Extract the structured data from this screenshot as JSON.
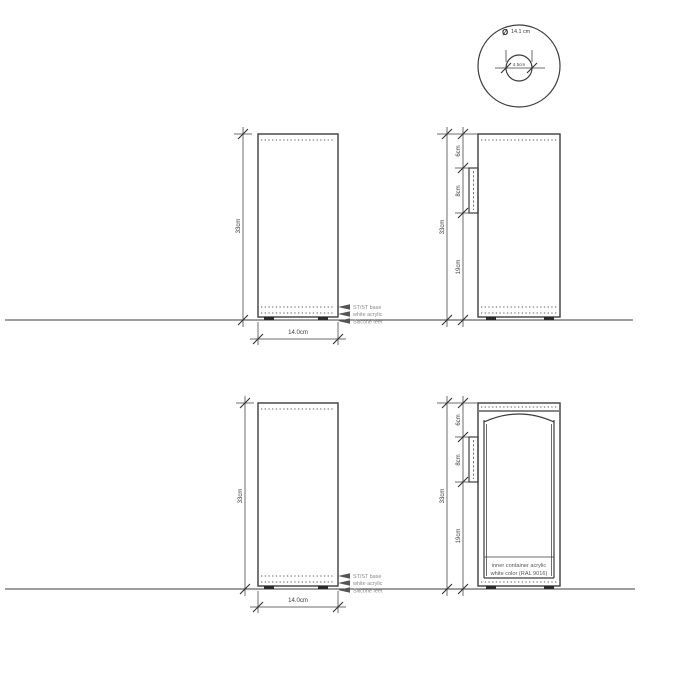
{
  "dimensions": {
    "height": "33cm",
    "width": "14.0cm",
    "segment_top": "6cm",
    "segment_middle": "8cm",
    "segment_bottom": "19cm"
  },
  "top_view": {
    "diameter_symbol": "Ø",
    "outer_diameter": "14.1 cm",
    "inner_diameter": "4.5cm"
  },
  "callouts": {
    "base": "ST/ST base",
    "acrylic": "white acrylic",
    "feet": "Silicone feet"
  },
  "section_note": {
    "line1": "inner container acrylic",
    "line2": "white color (RAL 9016)"
  },
  "colors": {
    "line": "#3d3d3d",
    "dim_text": "#3a3a3a",
    "callout_text": "#8a8a8a",
    "background": "#ffffff"
  }
}
